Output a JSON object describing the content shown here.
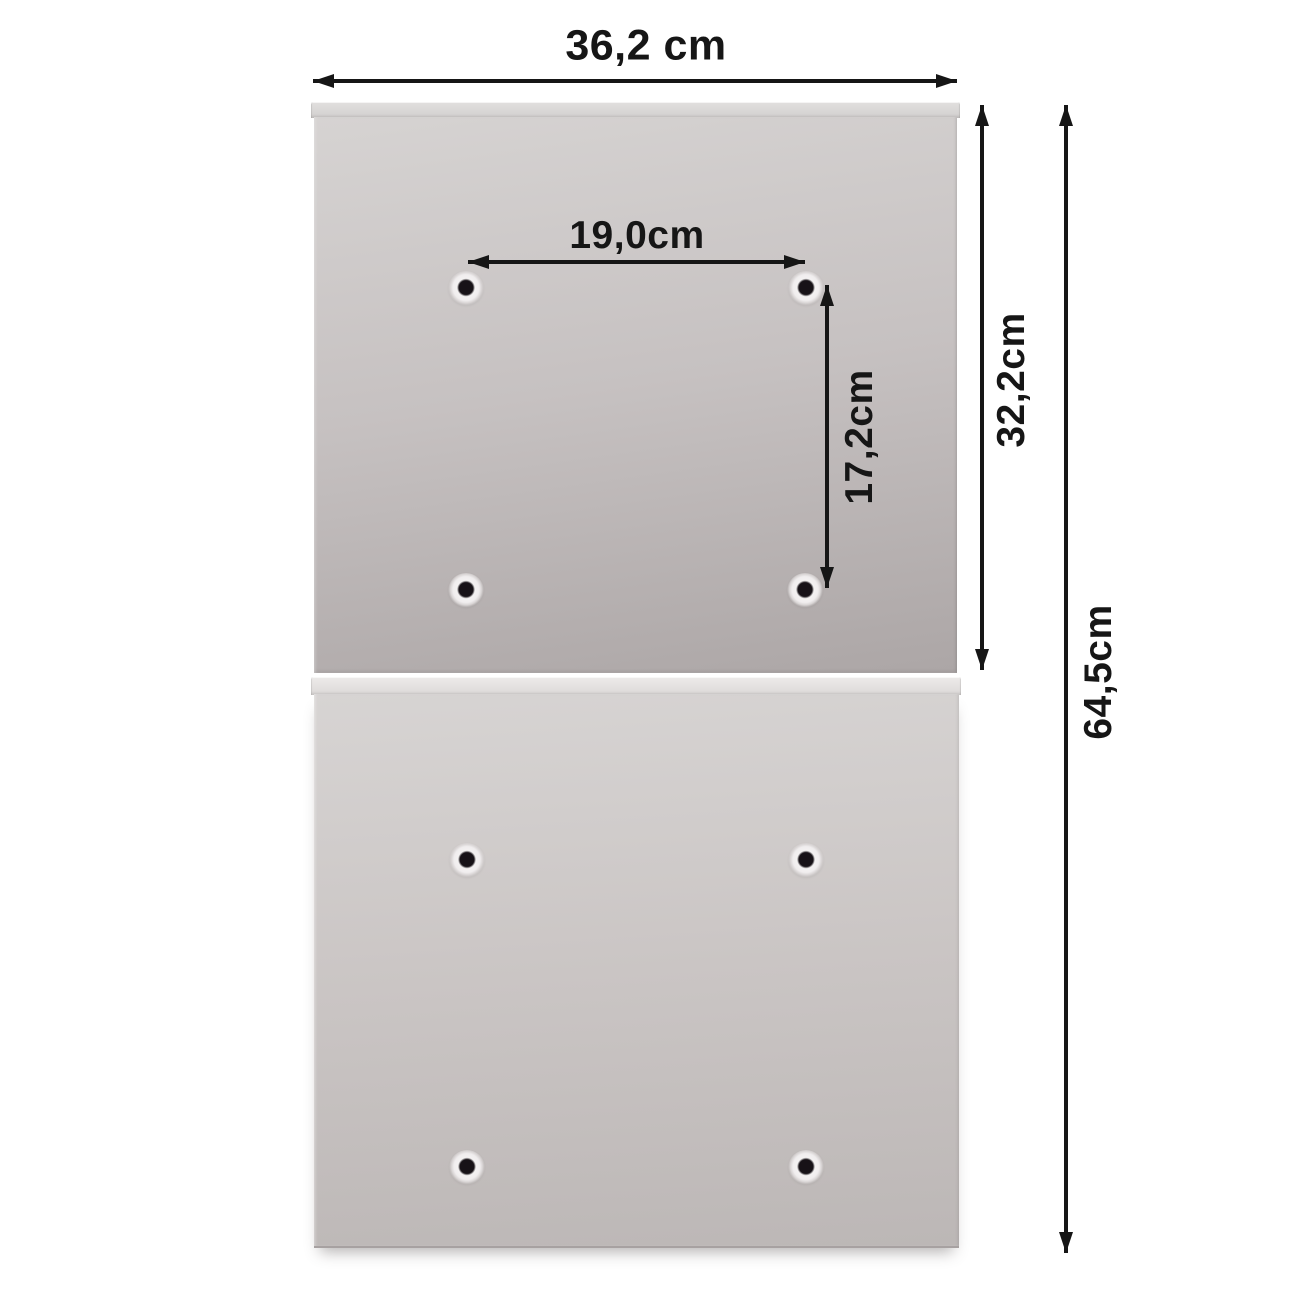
{
  "diagram": {
    "title": "product-mounting-dimensions",
    "background_color": "#ffffff",
    "arrow_color": "#161616",
    "panel_colors": {
      "upper_panel_light": "#d6d3d2",
      "upper_panel_dark": "#aca6a6",
      "lower_panel_light": "#d7d4d3",
      "lower_panel_dark": "#bcb7b6",
      "lip_light": "#edebea"
    },
    "dimensions": {
      "total_width": "36,2 cm",
      "hole_spacing_horizontal": "19,0cm",
      "hole_spacing_vertical": "17,2cm",
      "upper_panel_height": "32,2cm",
      "total_height": "64,5cm"
    },
    "panels": [
      {
        "name": "upper-panel",
        "mounting_holes": 4
      },
      {
        "name": "lower-panel",
        "mounting_holes": 4
      }
    ]
  }
}
